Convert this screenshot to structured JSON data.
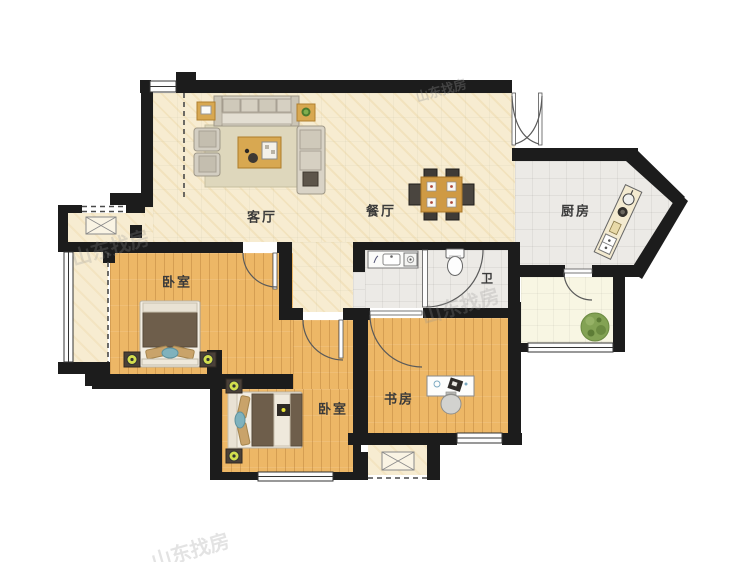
{
  "plan": {
    "title": "two-bed apartment floor plan",
    "watermark_text": "山东找房"
  },
  "rooms": {
    "living": {
      "label": "客厅"
    },
    "dining": {
      "label": "餐厅"
    },
    "kitchen": {
      "label": "厨房"
    },
    "bathroom": {
      "label": "卫"
    },
    "bedroom_master": {
      "label": "卧室"
    },
    "bedroom_second": {
      "label": "卧室"
    },
    "study": {
      "label": "书房"
    }
  },
  "palette": {
    "wall": "#1c1c1c",
    "floor_cream": "#f7ecd1",
    "floor_tile": "#eceae6",
    "floor_wood": "#edb766",
    "floor_balcony": "#f8f6e3",
    "rug": "#ded7bc",
    "sofa": "#d9d3c6",
    "wood_furniture": "#d8a851",
    "blanket": "#6e5e4b",
    "pillow_tan": "#c9a36a",
    "pillow_blue": "#7fb2bd",
    "lamp": "#d3de4e",
    "plant": "#83a254"
  }
}
